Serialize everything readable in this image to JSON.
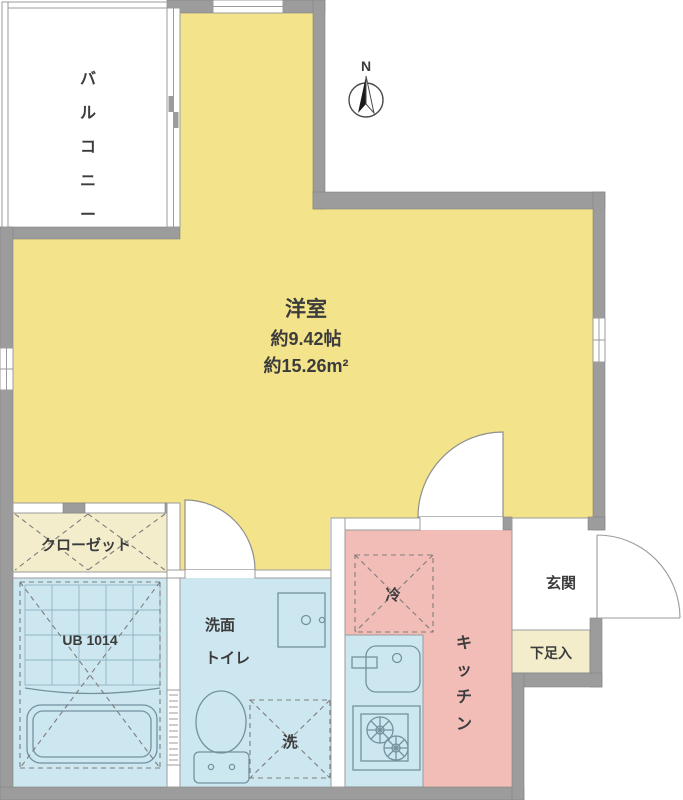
{
  "compass": {
    "north_label": "N"
  },
  "rooms": {
    "balcony": {
      "label": "バルコニー"
    },
    "main_room": {
      "name": "洋室",
      "size_jo": "約9.42帖",
      "size_m2": "約15.26m²"
    },
    "closet": {
      "label": "クローゼット"
    },
    "unit_bath": {
      "label": "UB 1014"
    },
    "washroom": {
      "label_line1": "洗面",
      "label_line2": "トイレ"
    },
    "washer": {
      "label": "洗"
    },
    "fridge": {
      "label": "冷"
    },
    "kitchen": {
      "label": "キッチン"
    },
    "entrance": {
      "label": "玄関"
    },
    "shoe_box": {
      "label": "下足入"
    }
  },
  "colors": {
    "room_yellow": "#F3E38A",
    "kitchen_pink": "#F2BDB7",
    "plumbing_blue": "#CDE7F0",
    "storage_cream": "#F3EDCB",
    "wall_gray": "#9C9C9C",
    "text_dark": "#3C3C3C"
  }
}
